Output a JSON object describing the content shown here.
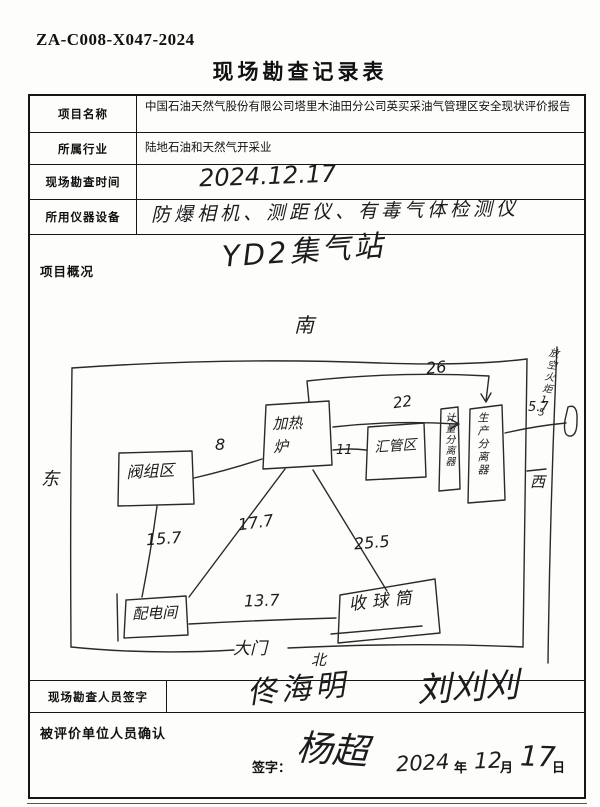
{
  "header": {
    "doc_number": "ZA-C008-X047-2024",
    "title": "现场勘查记录表"
  },
  "table": {
    "rows": [
      {
        "label": "项目名称",
        "value": "中国石油天然气股份有限公司塔里木油田分公司英买采油气管理区安全现状评价报告"
      },
      {
        "label": "所属行业",
        "value": "陆地石油和天然气开采业"
      },
      {
        "label": "现场勘查时间",
        "value": "2024.12.17"
      },
      {
        "label": "所用仪器设备",
        "value": "防爆相机、测距仪、有毒气体检测仪"
      }
    ]
  },
  "overview": {
    "label": "项目概况",
    "station_title": "YD2集气站",
    "compass": {
      "south": "南",
      "east": "东",
      "west": "西",
      "north": "北"
    },
    "gate": "大门",
    "flare_note": "放空火炬15",
    "nodes": {
      "valve_area": "阀组区",
      "heater": "加热炉",
      "manifold": "汇管区",
      "metering_separator": "计量分离器",
      "production_separator": "生产分离器",
      "power_room": "配电间",
      "pig_receiver": "收球筒"
    },
    "distances": {
      "d8": "8",
      "d11": "11",
      "d22": "22",
      "d26": "26",
      "d5_7": "5.7",
      "d15_7": "15.7",
      "d17_7": "17.7",
      "d25_5": "25.5",
      "d13_7": "13.7"
    }
  },
  "surveyor": {
    "label": "现场勘查人员签字",
    "sig1": "佟海明",
    "sig2": "刘刈刈"
  },
  "confirm": {
    "label": "被评价单位人员确认",
    "sign_label": "签字：",
    "signature": "杨超",
    "year": "2024",
    "year_unit": "年",
    "month": "12",
    "month_unit": "月",
    "day": "17",
    "day_unit": "日"
  }
}
